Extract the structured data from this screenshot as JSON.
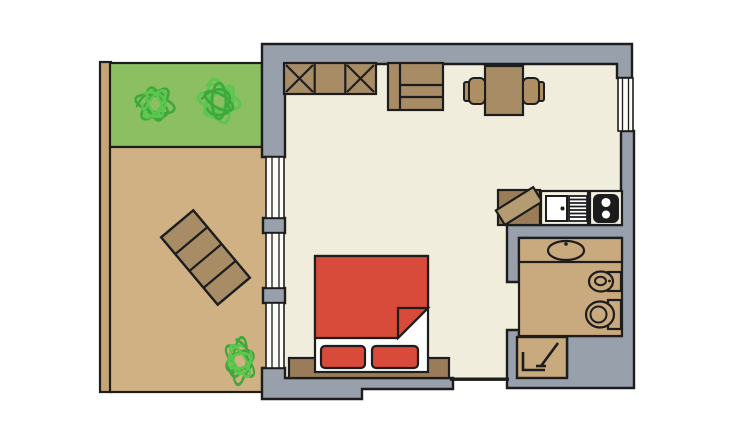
{
  "title": "studio apartment floor plan",
  "colors": {
    "background": "#FFFFFF",
    "wall": "#97A0AB",
    "outline": "#1D1D1D",
    "room_floor": "#F0EDDC",
    "terrace_floor": "#CFB183",
    "terrace_wall": "#C7A474",
    "lawn": "#8CBE62",
    "bush_dark": "#3FA83C",
    "bush_light": "#5BC74E",
    "wood": "#A78C66",
    "wood_dark": "#9A7D58",
    "wood_light": "#B59B72",
    "chair_wood": "#B08E63",
    "bed_red": "#D84B3A",
    "linen_white": "#FFFFFF",
    "stove_dark": "#1B1B1B",
    "bathroom_floor": "#C9A97E",
    "window_white": "#FBFBF7",
    "unit_white": "#F4F1E2"
  },
  "rooms": {
    "terrace": "terrace",
    "living_room": "living room",
    "kitchen": "kitchenette",
    "bathroom": "bathroom"
  },
  "furniture": {
    "wardrobe": "wardrobe",
    "dresser": "dresser",
    "dining_table": "dining table",
    "chair": "chair",
    "bed": "double bed",
    "blanket": "blanket",
    "pillow": "pillow",
    "headboard": "headboard",
    "sun_lounger": "sun lounger",
    "corner_unit": "corner cabinet",
    "kitchen_sink": "kitchen sink with drainer",
    "stove": "two-burner stove",
    "washbasin": "washbasin counter",
    "bidet": "bidet",
    "toilet": "toilet",
    "shower": "shower",
    "bush": "bush",
    "lawn": "lawn strip",
    "window": "window"
  }
}
